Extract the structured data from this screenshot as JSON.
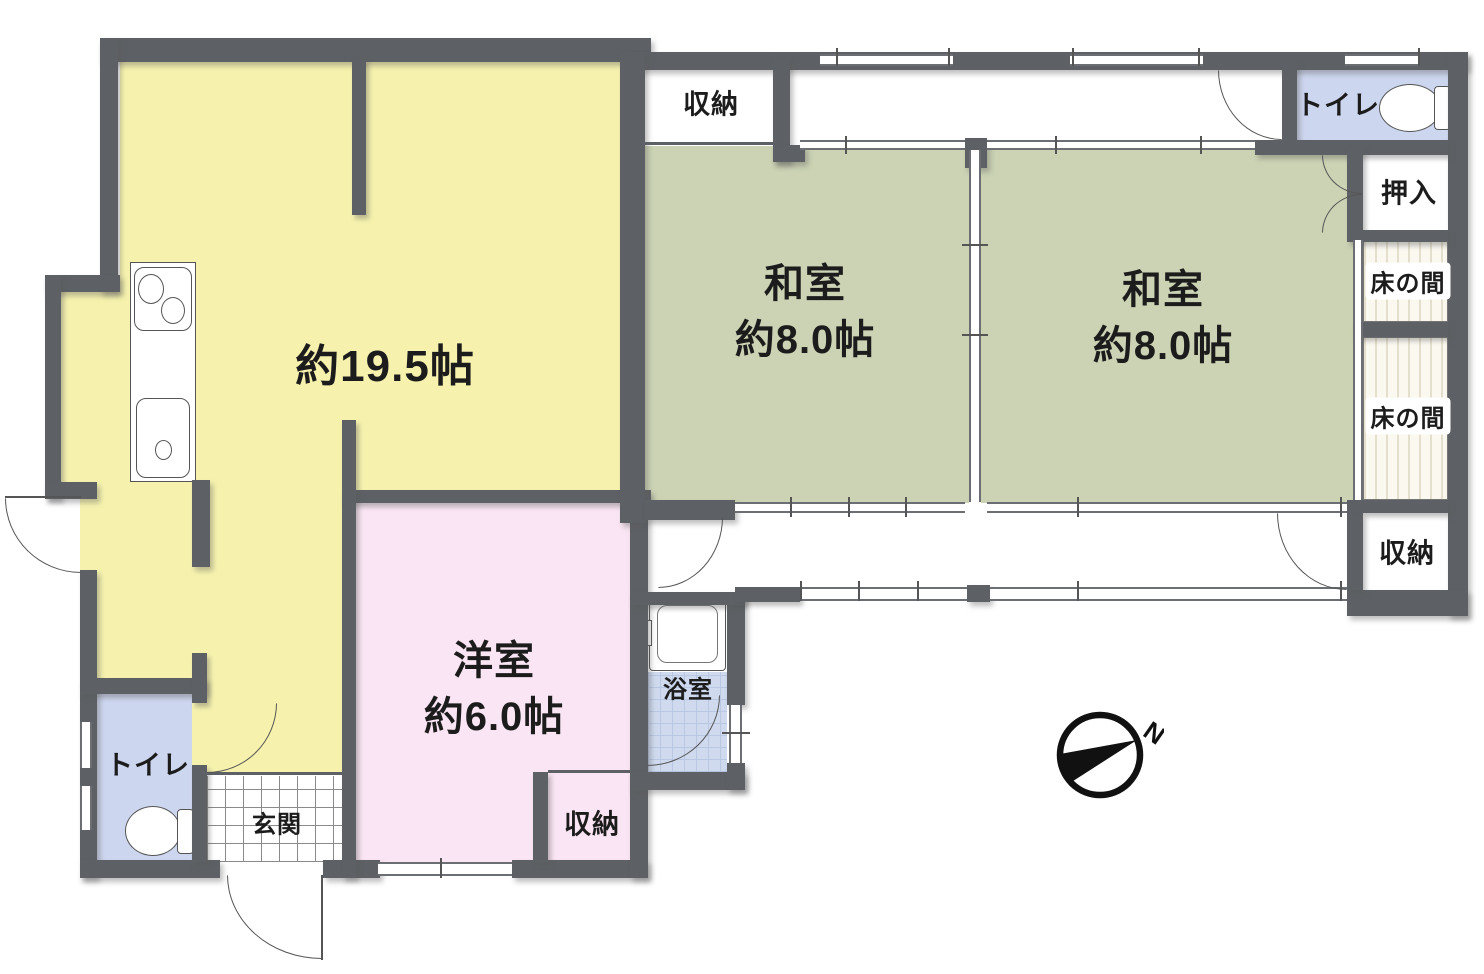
{
  "compass": {
    "north_label": "N"
  },
  "rooms": {
    "ldk": {
      "size_label": "約19.5帖"
    },
    "washitsu_left": {
      "name": "和室",
      "size_label": "約8.0帖"
    },
    "washitsu_right": {
      "name": "和室",
      "size_label": "約8.0帖"
    },
    "western_room": {
      "name": "洋室",
      "size_label": "約6.0帖"
    },
    "storage_top": {
      "name": "収納"
    },
    "storage_right": {
      "name": "収納"
    },
    "storage_bottom": {
      "name": "収納"
    },
    "toilet_top": {
      "name": "トイレ"
    },
    "toilet_bottom": {
      "name": "トイレ"
    },
    "closet_oshiire": {
      "name": "押入"
    },
    "tokonoma_upper": {
      "name": "床の間"
    },
    "tokonoma_lower": {
      "name": "床の間"
    },
    "bathroom": {
      "name": "浴室"
    },
    "entrance": {
      "name": "玄関"
    }
  },
  "colors": {
    "wall": "#5d6165",
    "ldk_floor": "#f6f2ae",
    "tatami_floor": "#cbd3b4",
    "western_floor": "#f9e5f3",
    "wet_area_floor": "#cdd6ef",
    "tokonoma_floor": "#faf8ef"
  }
}
